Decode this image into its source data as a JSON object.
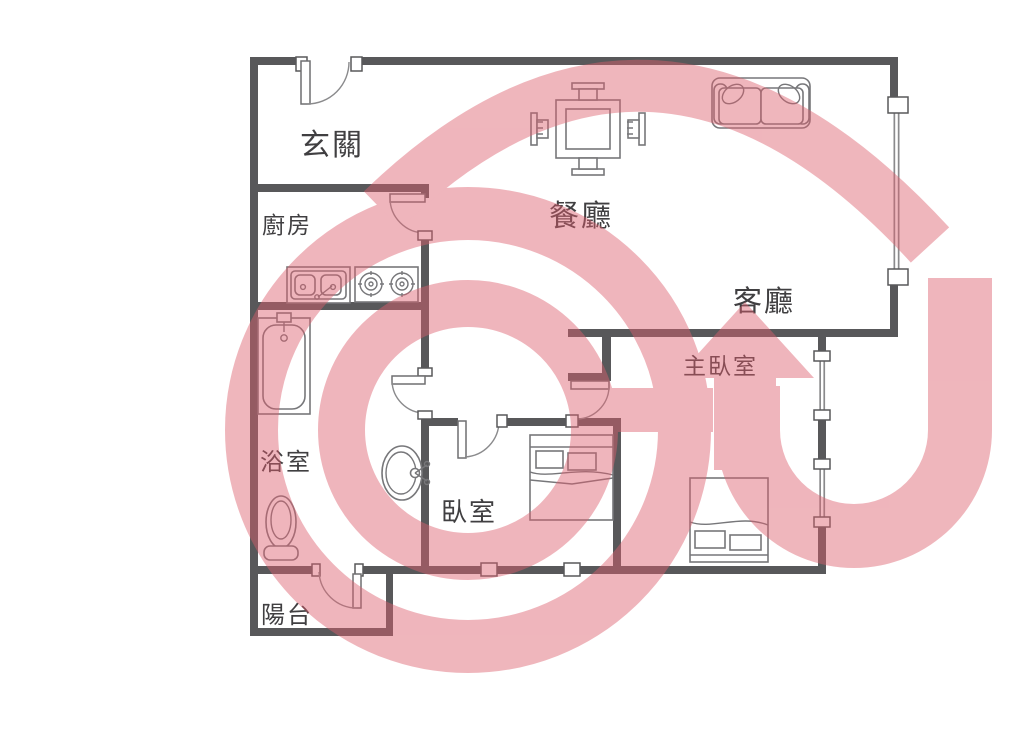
{
  "title": "apartment-floor-plan",
  "rooms": [
    {
      "name": "entry",
      "label": "玄關"
    },
    {
      "name": "kitchen",
      "label": "廚房"
    },
    {
      "name": "dining-room",
      "label": "餐廳"
    },
    {
      "name": "living-room",
      "label": "客廳"
    },
    {
      "name": "master-bedroom",
      "label": "主臥室"
    },
    {
      "name": "bathroom",
      "label": "浴室"
    },
    {
      "name": "bedroom",
      "label": "臥室"
    },
    {
      "name": "balcony",
      "label": "陽台"
    }
  ],
  "fixtures": [
    "entrance-door",
    "kitchen-door",
    "bathroom-door",
    "bedroom-door",
    "master-bedroom-door",
    "balcony-door",
    "dining-table-with-four-chairs",
    "two-seat-sofa",
    "kitchen-sink",
    "gas-stove",
    "bathtub",
    "washbasin",
    "toilet",
    "double-bed",
    "master-double-bed",
    "living-room-window",
    "master-bedroom-windows"
  ],
  "watermark": {
    "description": "pink G-with-house real-estate logo",
    "color": "#dd5f6e"
  },
  "colors": {
    "background": "#ffffff",
    "wall": "#58585a",
    "fixture_line": "#77777a",
    "label_text": "#403f41",
    "watermark_pink": "#dd5f6e"
  }
}
